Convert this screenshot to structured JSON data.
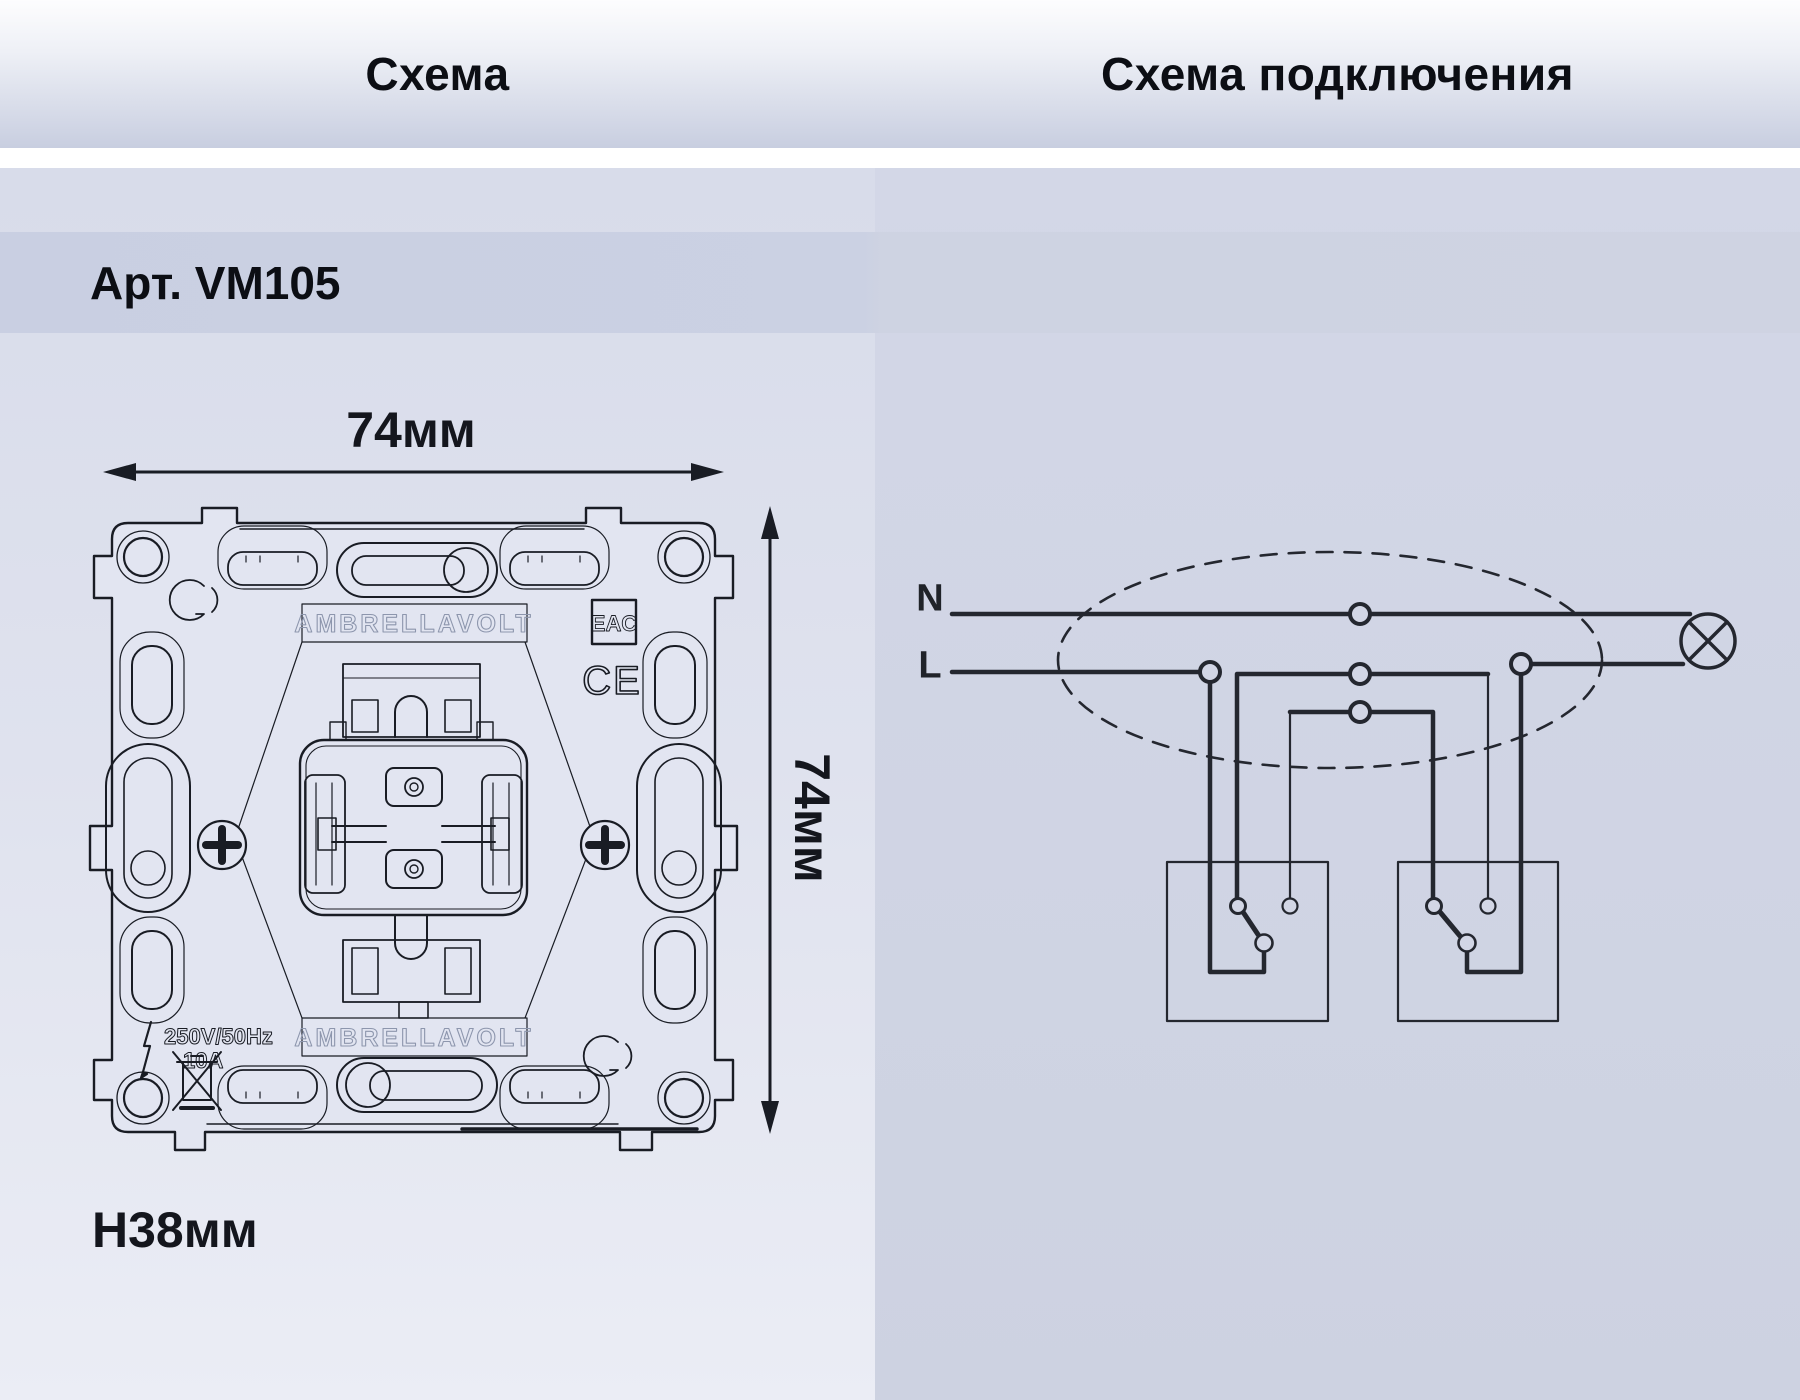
{
  "header": {
    "left_title": "Схема",
    "right_title": "Схема подключения"
  },
  "article": {
    "label": "Арт. VM105"
  },
  "dimensions": {
    "width_label": "74мм",
    "height_label": "74мм",
    "depth_label": "H38мм"
  },
  "mechanism": {
    "brand": "AMBRELLAVOLT",
    "rating_voltage": "250V/50Hz",
    "rating_current": "10A",
    "cert_eac": "EAC",
    "cert_ce": "CE"
  },
  "wiring": {
    "neutral_label": "N",
    "line_label": "L"
  },
  "colors": {
    "ink": "#191c24",
    "diagram_ink": "#24272f",
    "outline_text": "#8d96ad",
    "panel_left_bg": "#dfe2ee",
    "panel_right_bg": "#cfd4e3",
    "band_bg": "#c9cfe2",
    "header_bottom": "#c8cee0"
  }
}
